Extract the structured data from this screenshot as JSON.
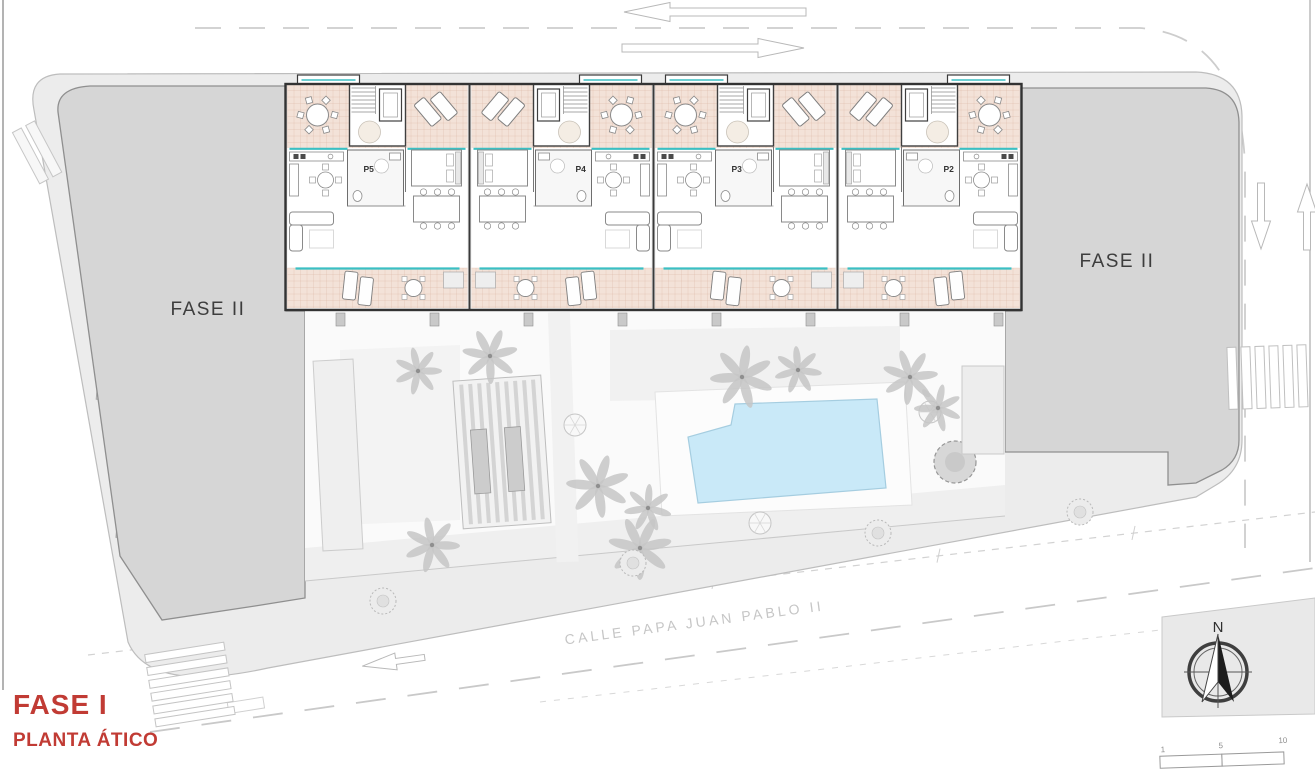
{
  "title_block": {
    "phase": "FASE I",
    "plan": "PLANTA ÁTICO"
  },
  "areas": {
    "left_block": "FASE II",
    "right_block": "FASE II"
  },
  "street": {
    "name": "CALLE PAPA JUAN PABLO II"
  },
  "compass": {
    "north": "N"
  },
  "scale_bar": {
    "ticks": [
      "1",
      "5",
      "10"
    ]
  },
  "units": [
    "P5",
    "P4",
    "P3",
    "P2"
  ],
  "colors": {
    "phase_red": "#c13b34",
    "terrace_tile": "#f3e2d8",
    "tile_grid": "#dcb9a8",
    "pool": "#c9e9f8",
    "pool_edge": "#a5cde0",
    "teal": "#3bbfc3",
    "block_gray": "#d6d6d6",
    "block_edge": "#8f8f8f",
    "sidewalk": "#ececec"
  }
}
